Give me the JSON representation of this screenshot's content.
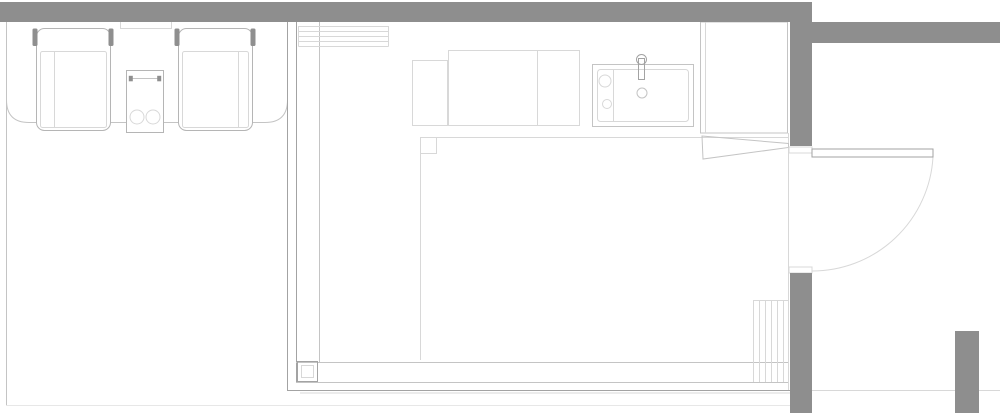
{
  "colors": {
    "background": "#ffffff",
    "wall-fill": "#8e8e8e",
    "line-strong": "#a3a3a3",
    "line-medium": "#c4c4c4",
    "line-light": "#d8d8d8",
    "line-faint": "#e7e7e7",
    "furniture-stroke": "#b5b5b5",
    "fixture-dark": "#8f8f8f"
  },
  "plan": {
    "type": "architectural-floor-plan",
    "elements": [
      "top-wall",
      "right-entry-wall-upper",
      "east-wall-segment",
      "right-entry-wall-lower",
      "south-east-pier",
      "terrace-boundary",
      "deck-outline",
      "lounge-chair-left",
      "lounge-chair-right",
      "side-table",
      "window-marker",
      "room-glass-walls",
      "bench-hatch",
      "kitchen-counter",
      "sink",
      "faucet",
      "wardrobe",
      "wardrobe-door",
      "rug-outline",
      "corner-column",
      "stairs-hatch",
      "entry-door-leaf",
      "entry-door-swing"
    ]
  }
}
